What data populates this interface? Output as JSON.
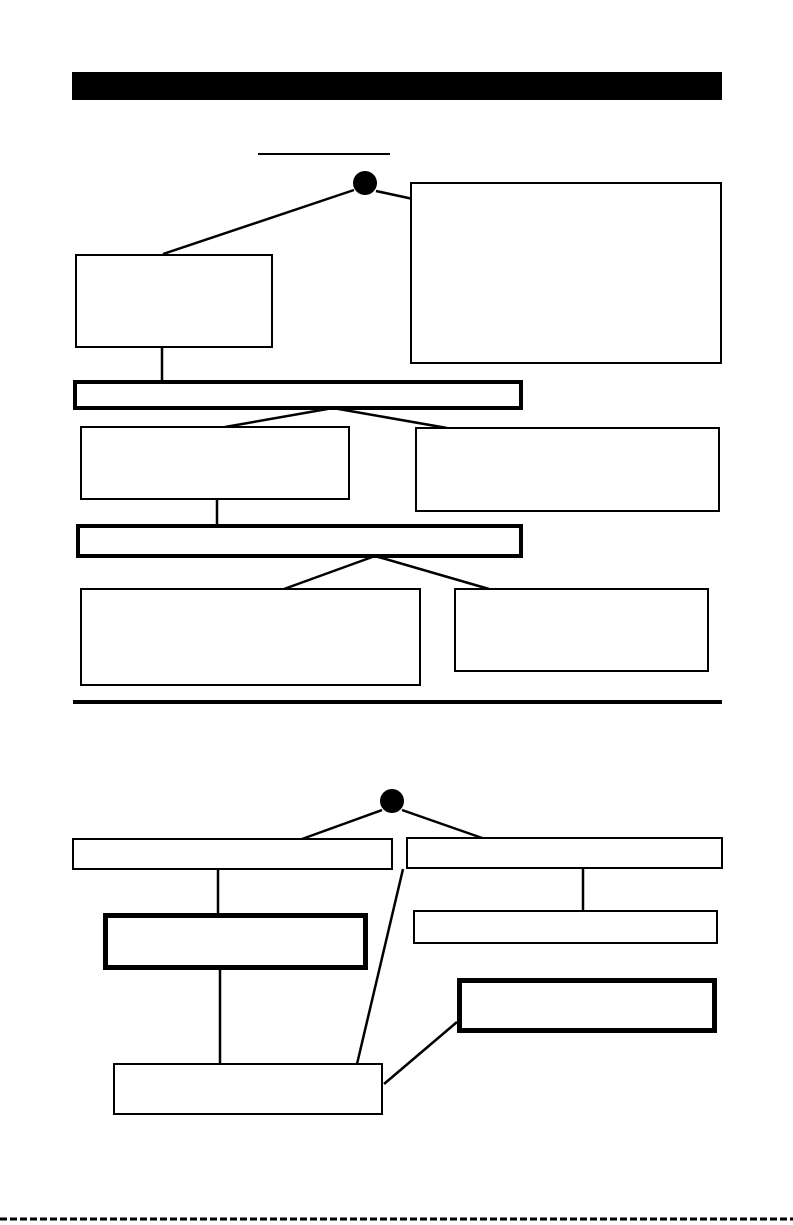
{
  "canvas": {
    "width": 793,
    "height": 1225,
    "background": "#ffffff",
    "ink_color": "#000000",
    "connector_thickness": 2.5,
    "description": "Scanned book page with a solid black header band and two blank organizational tree diagrams with empty boxes"
  },
  "header_bar": {
    "x": 72,
    "y": 72,
    "width": 650,
    "height": 28,
    "fill": "#000000",
    "text": ""
  },
  "section_divider": {
    "x": 73,
    "y": 700,
    "width": 649,
    "height": 4,
    "fill": "#000000"
  },
  "page_bottom_edge": {
    "x": 0,
    "y": 1219,
    "width": 793,
    "thickness": 3,
    "style": "dashed"
  },
  "diagrams": [
    {
      "name": "top-tree-diagram",
      "title_underline": {
        "x1": 258,
        "y1": 154,
        "x2": 390,
        "y2": 154,
        "thickness": 2
      },
      "root_node": {
        "shape": "filled-circle",
        "cx": 365,
        "cy": 183,
        "r": 12,
        "fill": "#000000"
      },
      "boxes": [
        {
          "id": "d1-left-box",
          "x": 75,
          "y": 254,
          "width": 198,
          "height": 94,
          "border": 2,
          "text": ""
        },
        {
          "id": "d1-right-large-box",
          "x": 410,
          "y": 182,
          "width": 312,
          "height": 182,
          "border": 2,
          "text": ""
        },
        {
          "id": "d1-wide-bar-1",
          "x": 73,
          "y": 380,
          "width": 450,
          "height": 30,
          "border": 4,
          "text": ""
        },
        {
          "id": "d1-row2-left-box",
          "x": 80,
          "y": 426,
          "width": 270,
          "height": 74,
          "border": 2,
          "text": ""
        },
        {
          "id": "d1-row2-right-box",
          "x": 415,
          "y": 427,
          "width": 305,
          "height": 85,
          "border": 2,
          "text": ""
        },
        {
          "id": "d1-wide-bar-2",
          "x": 76,
          "y": 524,
          "width": 447,
          "height": 34,
          "border": 4,
          "text": ""
        },
        {
          "id": "d1-row3-left-box",
          "x": 80,
          "y": 588,
          "width": 341,
          "height": 98,
          "border": 2,
          "text": ""
        },
        {
          "id": "d1-row3-right-box",
          "x": 454,
          "y": 588,
          "width": 255,
          "height": 84,
          "border": 2,
          "text": ""
        }
      ],
      "connectors": [
        {
          "x1": 354,
          "y1": 190,
          "x2": 163,
          "y2": 254
        },
        {
          "x1": 376,
          "y1": 191,
          "x2": 413,
          "y2": 199
        },
        {
          "x1": 162,
          "y1": 348,
          "x2": 162,
          "y2": 382
        },
        {
          "x1": 333,
          "y1": 408,
          "x2": 225,
          "y2": 427
        },
        {
          "x1": 333,
          "y1": 408,
          "x2": 447,
          "y2": 428
        },
        {
          "x1": 217,
          "y1": 500,
          "x2": 217,
          "y2": 526
        },
        {
          "x1": 375,
          "y1": 556,
          "x2": 284,
          "y2": 589
        },
        {
          "x1": 375,
          "y1": 556,
          "x2": 489,
          "y2": 589
        }
      ]
    },
    {
      "name": "bottom-tree-diagram",
      "title_underline": null,
      "root_node": {
        "shape": "filled-circle",
        "cx": 392,
        "cy": 801,
        "r": 12,
        "fill": "#000000"
      },
      "boxes": [
        {
          "id": "d2-left-flat-box",
          "x": 72,
          "y": 838,
          "width": 321,
          "height": 32,
          "border": 2,
          "text": ""
        },
        {
          "id": "d2-right-flat-box",
          "x": 406,
          "y": 837,
          "width": 317,
          "height": 32,
          "border": 2,
          "text": ""
        },
        {
          "id": "d2-left-thick-box",
          "x": 103,
          "y": 913,
          "width": 265,
          "height": 57,
          "border": 5,
          "text": ""
        },
        {
          "id": "d2-right-sub-box",
          "x": 413,
          "y": 910,
          "width": 305,
          "height": 34,
          "border": 2,
          "text": ""
        },
        {
          "id": "d2-right-thick-box",
          "x": 457,
          "y": 978,
          "width": 260,
          "height": 55,
          "border": 5,
          "text": ""
        },
        {
          "id": "d2-bottom-box",
          "x": 113,
          "y": 1063,
          "width": 270,
          "height": 52,
          "border": 2,
          "text": ""
        }
      ],
      "connectors": [
        {
          "x1": 382,
          "y1": 810,
          "x2": 302,
          "y2": 839
        },
        {
          "x1": 402,
          "y1": 810,
          "x2": 485,
          "y2": 839
        },
        {
          "x1": 218,
          "y1": 869,
          "x2": 218,
          "y2": 915
        },
        {
          "x1": 583,
          "y1": 868,
          "x2": 583,
          "y2": 912
        },
        {
          "x1": 403,
          "y1": 869,
          "x2": 357,
          "y2": 1064
        },
        {
          "x1": 220,
          "y1": 969,
          "x2": 220,
          "y2": 1064
        },
        {
          "x1": 457,
          "y1": 1022,
          "x2": 384,
          "y2": 1084
        }
      ]
    }
  ]
}
